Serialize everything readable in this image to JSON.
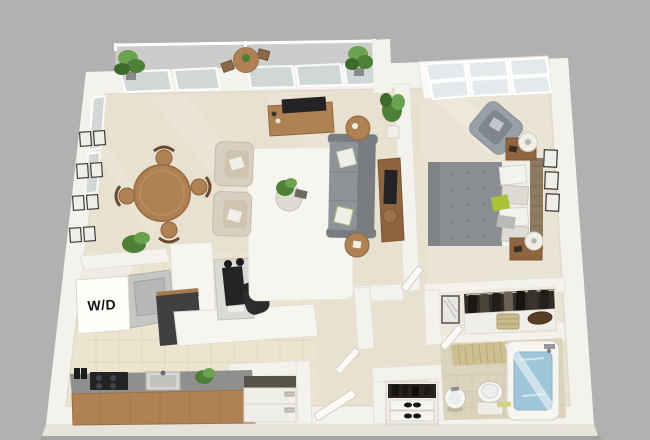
{
  "scene": {
    "kind": "3D floor plan render",
    "unit": "one-bedroom apartment",
    "view": "isometric top-down"
  },
  "labels": {
    "washer_dryer": "W/D"
  },
  "colors": {
    "background": "#b1b1b1",
    "wall": "#f4f2ec",
    "wall_shade": "#e6e3db",
    "floor_main": "#e8e1d0",
    "floor_tile": "#ece4cf",
    "floor_bath": "#dcd3bd",
    "rug": "#f6f5f0",
    "sofa": "#8f9297",
    "sofa_dark": "#797c80",
    "duvet": "#8a8d91",
    "bed_linen": "#f0eee9",
    "accent_pillow": "#a9c238",
    "wood": "#b08153",
    "wood_dark": "#8f6440",
    "beige_chair": "#d9cfc0",
    "plant": "#4e8038",
    "plant_light": "#6aa24f",
    "water": "#9fc6d8",
    "glass": "#ccd2d3",
    "appliance_dark": "#232325",
    "countertop": "#8f8f8d",
    "fixture_white": "#f7f5f0",
    "closet_dark": "#312d27"
  },
  "rooms": {
    "balcony": {
      "items": [
        "potted-plant",
        "bistro-table",
        "bistro-chair",
        "bistro-chair",
        "potted-plant",
        "glass-railing"
      ]
    },
    "living_room": {
      "items": [
        "media-console",
        "tv",
        "armchair",
        "armchair",
        "area-rug",
        "coffee-table",
        "potted-plant",
        "sofa",
        "throw-pillow",
        "throw-pillow",
        "side-table",
        "side-table",
        "console-desk",
        "stool",
        "floor-plant"
      ]
    },
    "dining_area": {
      "items": [
        "dining-table",
        "dining-chair",
        "dining-chair",
        "dining-chair",
        "dining-chair",
        "gallery-wall-frames"
      ]
    },
    "kitchen": {
      "items": [
        "washer-dryer",
        "wall-shelf",
        "potted-plant",
        "counter",
        "stove",
        "sink",
        "refrigerator",
        "peninsula-counter",
        "base-cabinet",
        "computer-desk",
        "office-chair"
      ]
    },
    "bedroom": {
      "items": [
        "window",
        "armchair",
        "bed",
        "headboard",
        "nightstand",
        "table-lamp",
        "nightstand",
        "table-lamp",
        "wall-frames",
        "accent-pillow"
      ]
    },
    "bathroom": {
      "items": [
        "pedestal-sink",
        "toilet",
        "bathtub",
        "shower-screen",
        "bamboo-mat",
        "bath-mat"
      ]
    },
    "hall": {
      "items": [
        "closet-clothes",
        "storage-basket",
        "mirror-cabinet",
        "shoe-cabinet",
        "entry-door",
        "bedroom-door",
        "bathroom-door",
        "hall-door"
      ]
    }
  }
}
